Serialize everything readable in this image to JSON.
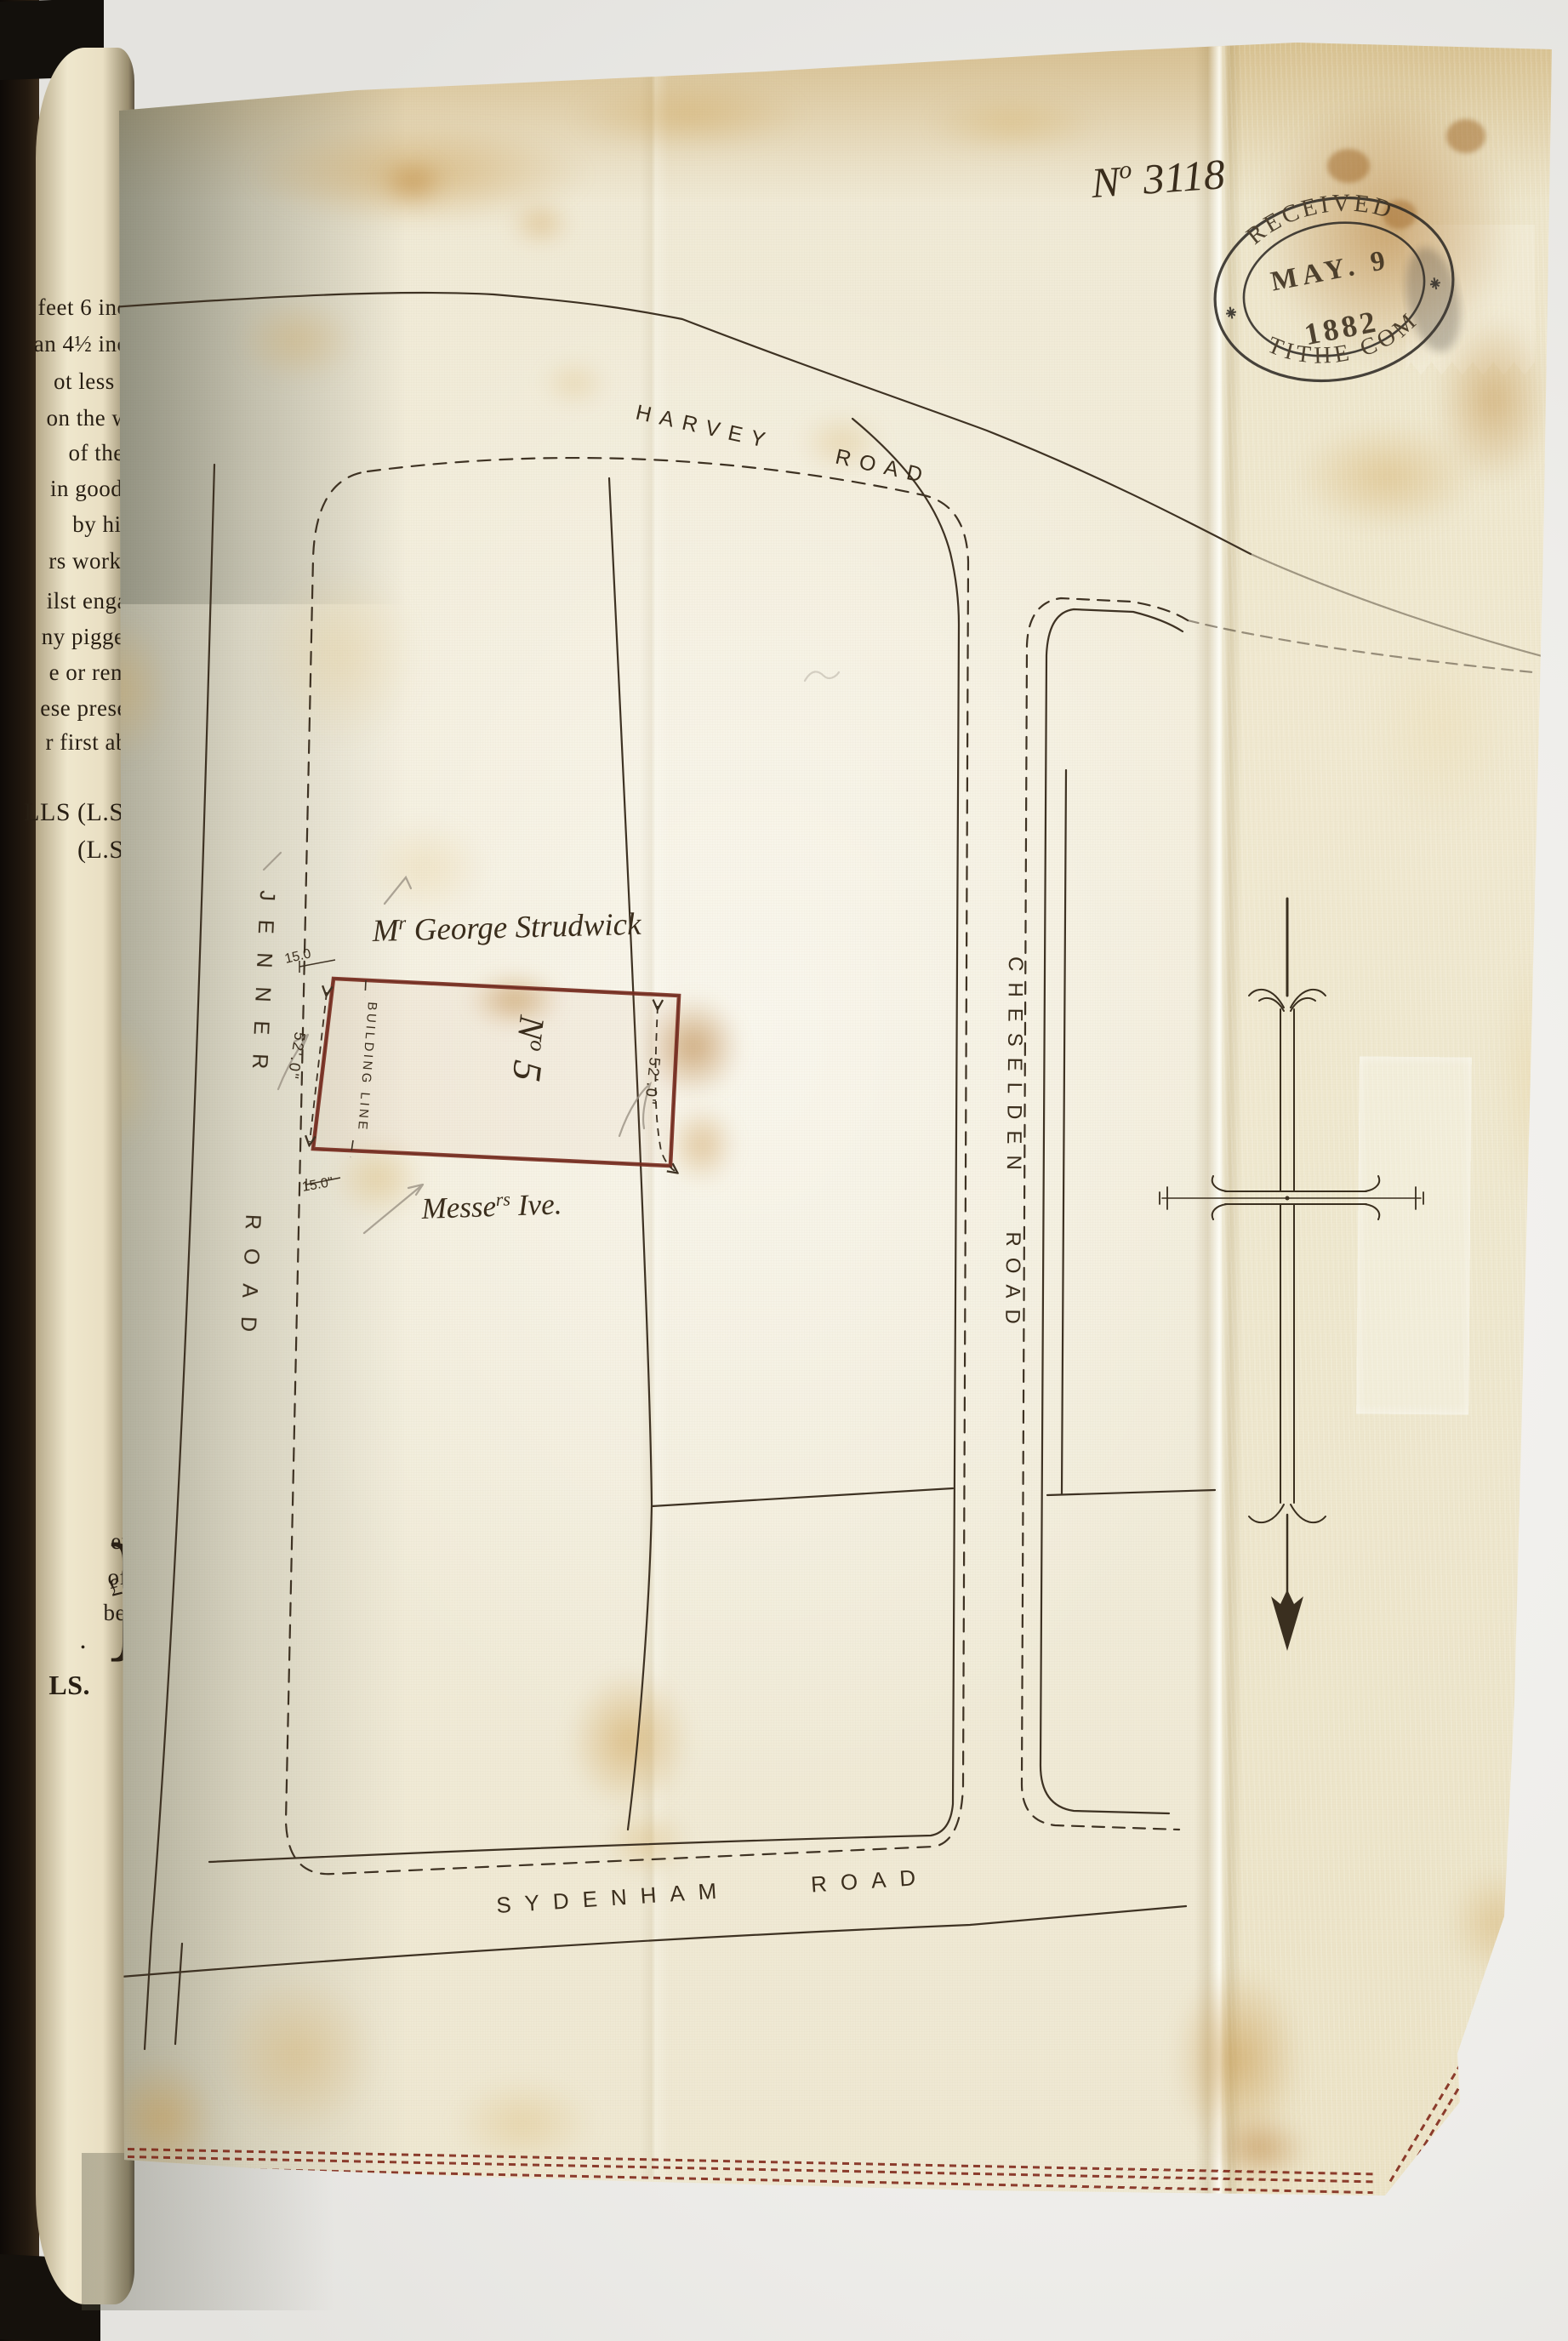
{
  "document": {
    "number_main": "N",
    "number_sup": "o",
    "number_value": " 3118"
  },
  "stamp": {
    "top": "RECEIVED",
    "date": "MAY. 9",
    "year": "1882",
    "bottom": "TITHE COM"
  },
  "roads": {
    "north": "HARVEY ROAD",
    "west": "JENNER ROAD",
    "east": "CHESELDEN ROAD",
    "south": "SYDENHAM ROAD"
  },
  "plot": {
    "owner_main": "M",
    "owner_sup": "r",
    "owner_name": " George Strudwick",
    "number_main": "N",
    "number_sup": "o",
    "number_value": " 5",
    "neighbour_main": "Messe",
    "neighbour_sup": "rs",
    "neighbour_name": " Ive.",
    "building_line": "BUILDING LINE",
    "frontage_top": "15.0",
    "frontage_bottom": "15.0\"",
    "depth_west": "52'.0\"",
    "depth_east": "52'.0\""
  },
  "page": {
    "lines": [
      "feet 6 inch",
      "an 4½ inch",
      "ot less th",
      "on the we",
      "of the s",
      "in good a",
      "by him",
      "rs workm",
      "ilst engag",
      "ny piggeri",
      "e or rema",
      "ese presen",
      "r first abo",
      "LLS (L.S.)",
      "(L.S.)"
    ],
    "bottom_lines": [
      "en,",
      "of",
      "be"
    ],
    "brace": "}",
    "amount": "£10",
    "period": ".",
    "signature": "LS."
  },
  "colors": {
    "ink": "#3e3223",
    "plot_outline": "#7b2f22",
    "stitching": "#7a1e10",
    "stamp_ink": "#2f2b26",
    "pencil": "#9a9184"
  }
}
